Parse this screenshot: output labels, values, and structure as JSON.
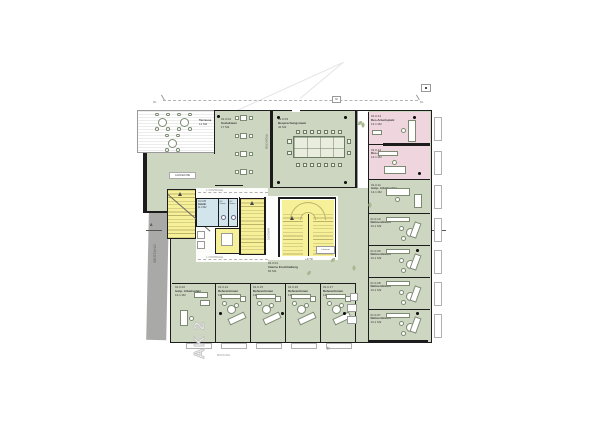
{
  "colors": {
    "office_green": "#cdd6c0",
    "reserved_pink": "#efd6de",
    "stair_yellow": "#f6f099",
    "sanitary_blue": "#d2e5ec",
    "existing_gray": "#a9a9a7",
    "wall_black": "#1c1c1c"
  },
  "grid": {
    "left": "B1",
    "right": "B1",
    "dim": "60"
  },
  "bestand": {
    "label": "BESTAND"
  },
  "section": {
    "a_left": "A",
    "a_right": "A",
    "cut_11": "11"
  },
  "big_label": {
    "text": "AK 2",
    "sub": "BILDUNG"
  },
  "control": {
    "line1": "1. KONTROLLE",
    "line2": "1. KONTROLLE"
  },
  "core": {
    "projektion": "PROJEKTION",
    "garderobe": "GARDEROBE",
    "anrichte": "ANRICHTE",
    "luftraum": "Luftraum",
    "level": "+3.70"
  },
  "rooms": {
    "terrasse": {
      "name": "Terrasse",
      "area": "11 M2"
    },
    "sozialraum": {
      "id": "01.0.04",
      "name": "Sozialraum",
      "area": "17 M2"
    },
    "besprechung": {
      "id": "01.0.03",
      "name": "Besprechungsraum",
      "area": "42 M2"
    },
    "sanitaer": {
      "id": "01.0.05",
      "name": "Sanitär",
      "area": "11.0 M2",
      "wc_damen": "WC Damen",
      "wc_herren": "WC Herren"
    },
    "erschliessung": {
      "id": "01.0.01",
      "name": "Interne Erschließung",
      "area": "81 M2"
    },
    "right": [
      {
        "id": "01.0.13",
        "name": "Res.Arbeitsplatz",
        "area": "13.1 M2"
      },
      {
        "id": "01.0.12",
        "name": "Res.Arbeitsplatz",
        "area": "13.1 M2"
      },
      {
        "id": "01.0.11",
        "name": "temp. Arbeitsplatz",
        "area": "13.1 M2"
      },
      {
        "id": "01.0.10",
        "name": "Referentinnen",
        "area": "13.1 M2"
      },
      {
        "id": "01.0.09",
        "name": "Referentinnen",
        "area": "13.1 M2"
      },
      {
        "id": "01.0.08",
        "name": "Referentinnen",
        "area": "13.1 M2"
      },
      {
        "id": "01.0.07",
        "name": "Referentinnen",
        "area": "13.1 M2"
      }
    ],
    "bottom": [
      {
        "id": "01.0.02",
        "name": "temp. Arbeitsplatz",
        "area": "13.1 M2"
      },
      {
        "id": "01.0.14",
        "name": "Referentinnen",
        "area": "13.1 M2"
      },
      {
        "id": "01.0.15",
        "name": "Referentinnen",
        "area": "13.1 M2"
      },
      {
        "id": "01.0.16",
        "name": "Referentinnen",
        "area": "13.1 M2"
      },
      {
        "id": "01.0.17",
        "name": "Referentinnen",
        "area": "13.1 M2"
      }
    ]
  }
}
